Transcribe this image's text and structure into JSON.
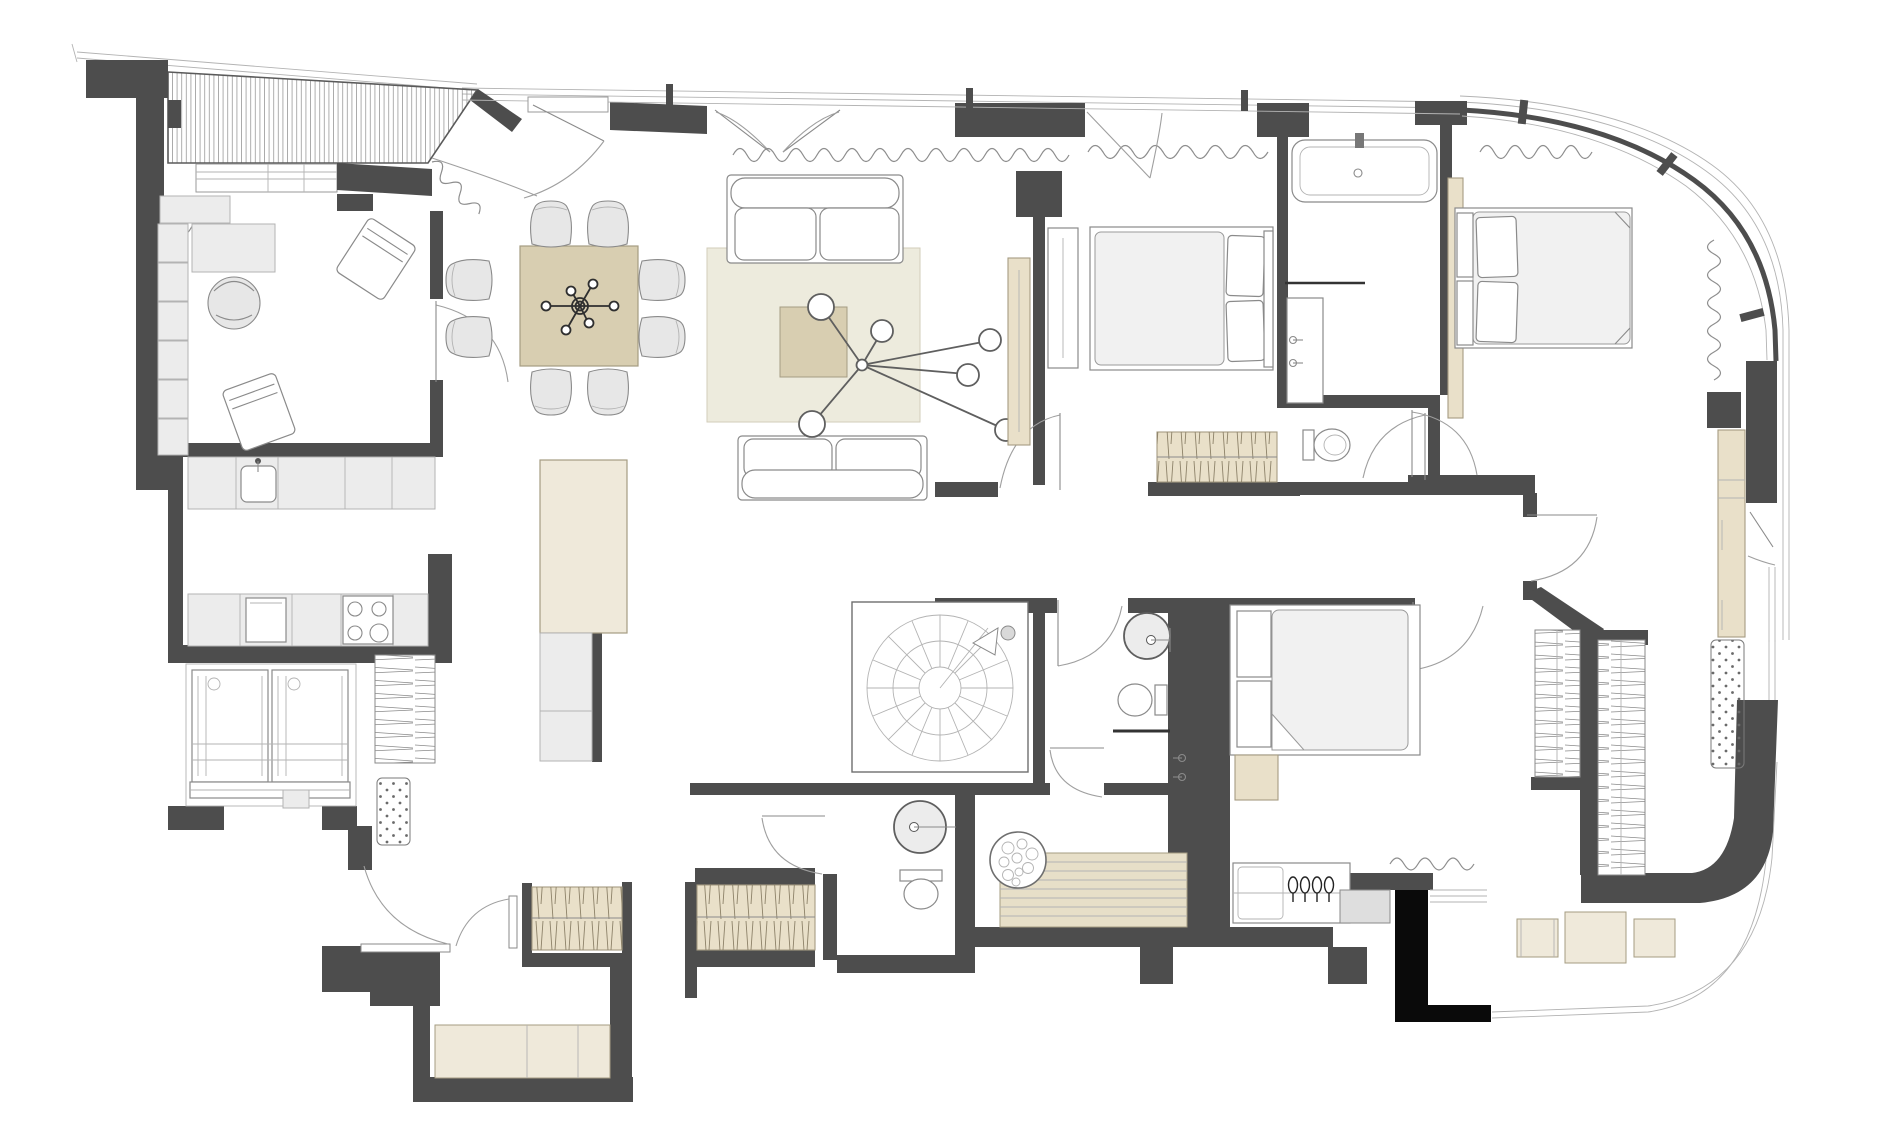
{
  "document": {
    "kind": "architectural-floor-plan",
    "visible_text": []
  },
  "colors": {
    "paper": "#ffffff",
    "white": "#ffffff",
    "wall": "#4d4d4d",
    "black": "#0a0a0a",
    "ink": "#2f2f2f",
    "line": "#8a8a8a",
    "line_dark": "#5f5f5f",
    "line_soft": "#b3b3b3",
    "arc": "#9f9f9f",
    "curtain": "#8d8d8d",
    "glass": "#9a9a9a",
    "deck_line": "#9a9a9a",
    "gray_furn": "#e7e7e7",
    "gray_soft": "#ececec",
    "beige_table": "#d8ceb1",
    "beige_rug": "#edebdd",
    "beige_closet": "#e9e0c9",
    "beige_cab": "#efe9da",
    "beige_slat": "#e7dfc8",
    "beige_edge": "#a59c82",
    "beige_rug_edge": "#d2cdba",
    "hatch": "#8c8168",
    "appliance": "#dedede"
  },
  "icons": [
    "terrace-deck",
    "dining-table",
    "ceiling-lamp",
    "sofa",
    "area-rug",
    "coffee-table",
    "kitchen-island",
    "sink",
    "cooktop",
    "oven",
    "washing-machines",
    "spiral-stair",
    "double-bed",
    "wardrobe-hatch",
    "bathtub",
    "toilet",
    "round-sink",
    "shower-head",
    "pebble-shower-floor",
    "sauna-bench",
    "vanity-counter",
    "doormat",
    "door-swing",
    "window-band",
    "curtain-wave",
    "curved-glass-wall",
    "balcony-stools",
    "dresser",
    "desk",
    "armchair"
  ]
}
